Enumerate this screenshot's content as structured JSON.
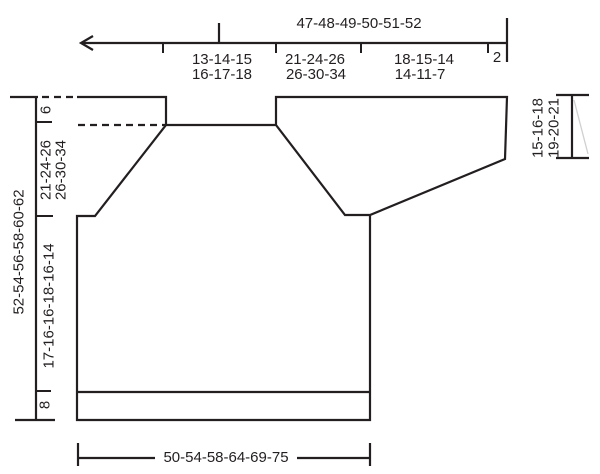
{
  "colors": {
    "ink": "#231f20",
    "faint": "#d0d0d0",
    "background": "#ffffff"
  },
  "diagram_type": "knitting-pattern-schematic",
  "top_ruler": {
    "total_width": "47-48-49-50-51-52",
    "segments": [
      {
        "line1": "13-14-15",
        "line2": "16-17-18"
      },
      {
        "line1": "21-24-26",
        "line2": "26-30-34"
      },
      {
        "line1": "18-15-14",
        "line2": "14-11-7"
      },
      {
        "line1": "2",
        "line2": ""
      }
    ]
  },
  "left_ruler": {
    "total_length": "52-54-56-58-60-62",
    "neck_depth": "6",
    "yoke_line1": "21-24-26",
    "yoke_line2": "26-30-34",
    "body_length": "17-16-16-18-16-14",
    "rib_height": "8"
  },
  "right_ruler": {
    "line1": "15-16-18",
    "line2": "19-20-21"
  },
  "bottom_ruler": {
    "width": "50-54-58-64-69-75"
  }
}
